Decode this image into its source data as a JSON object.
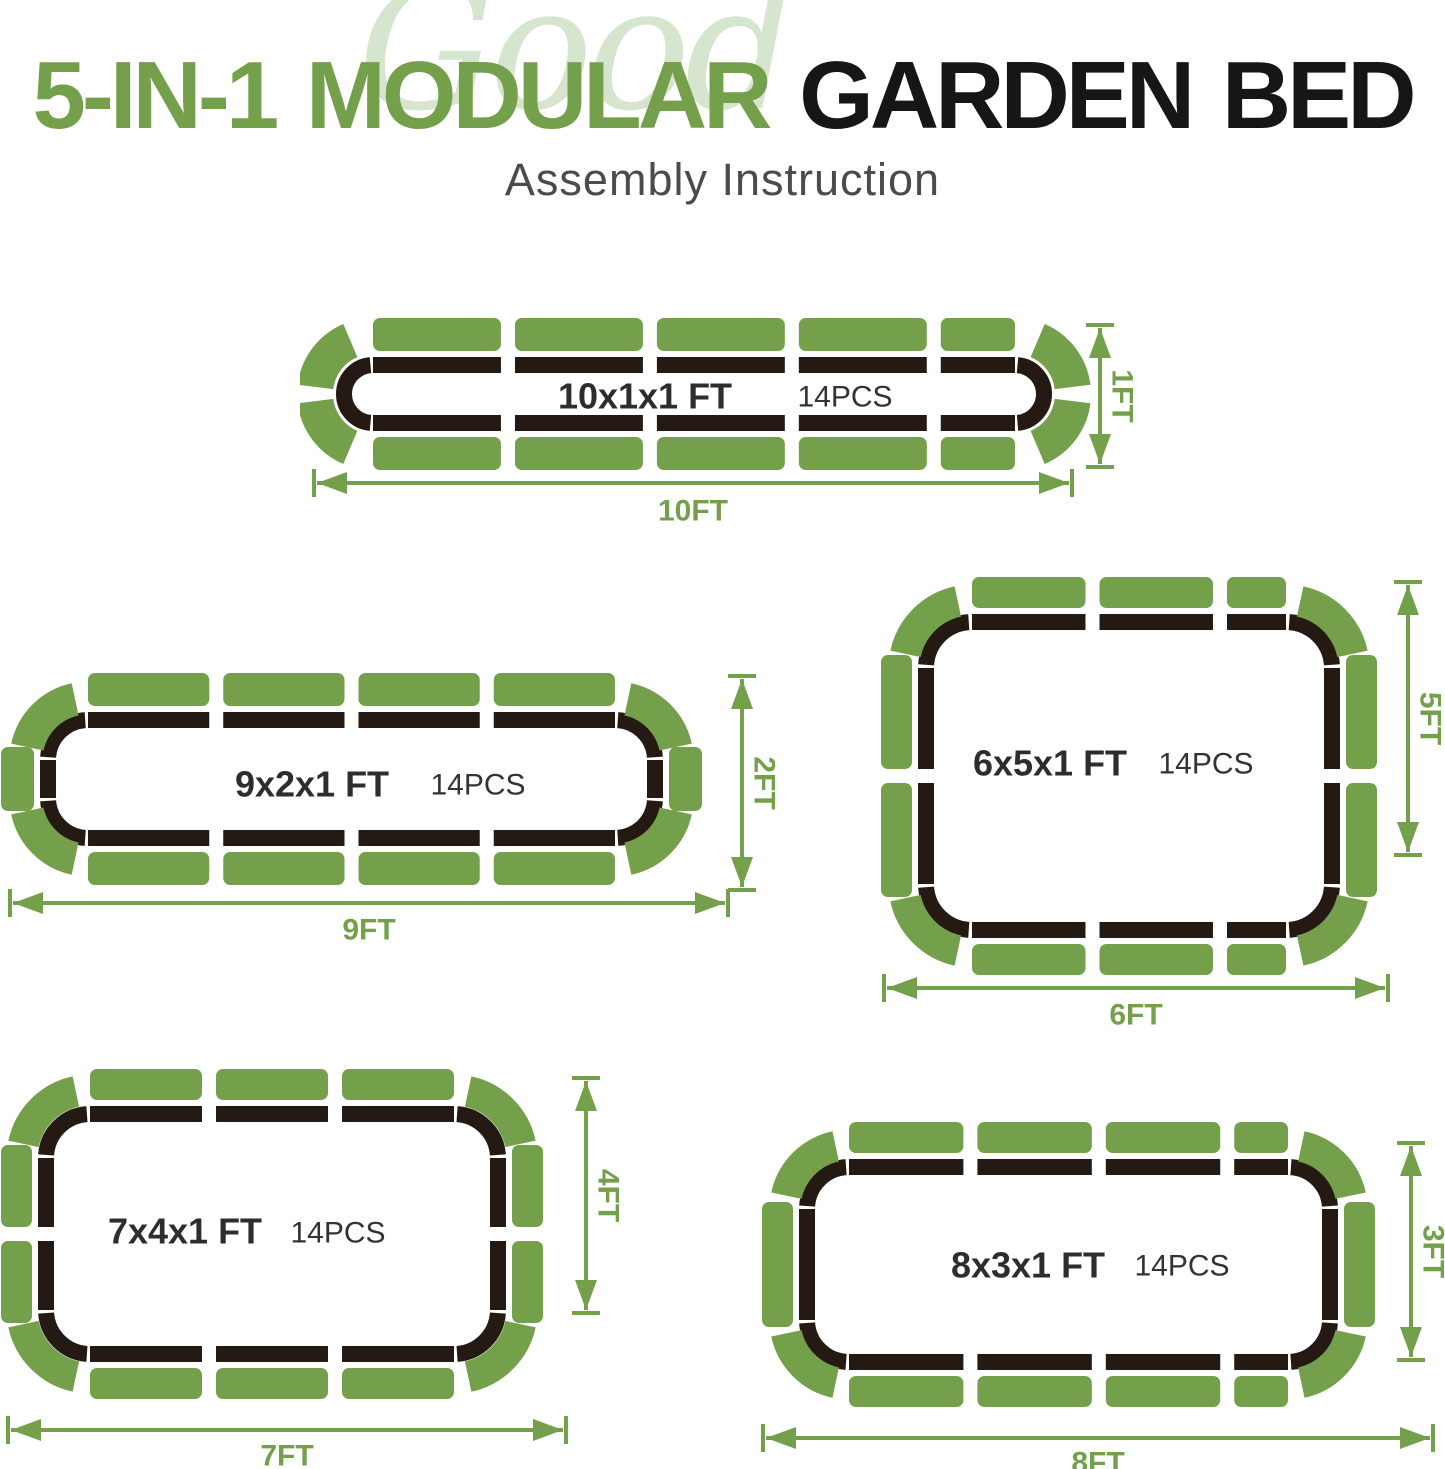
{
  "header": {
    "watermark": "Good",
    "title_green": "5-IN-1 MODULAR",
    "title_dark": "GARDEN BED",
    "subtitle": "Assembly Instruction"
  },
  "colors": {
    "green": "#74A04B",
    "black": "#241A13",
    "watermark_green": "#CCDFC2",
    "title_dark": "#161616",
    "subtitle_gray": "#4B4B4B",
    "label_dark": "#2D2D2D",
    "pcs_dark": "#333333"
  },
  "beds": [
    {
      "name": "10x1x1-ft",
      "size_label": "10x1x1 FT",
      "pcs_label": "14PCS",
      "width_label": "10FT",
      "height_label": "1FT",
      "pieces": {
        "top": 5,
        "bottom": 5,
        "left": 0,
        "right": 0,
        "corners": 4,
        "total": 14
      }
    },
    {
      "name": "9x2x1-ft",
      "size_label": "9x2x1 FT",
      "pcs_label": "14PCS",
      "width_label": "9FT",
      "height_label": "2FT",
      "pieces": {
        "top": 4,
        "bottom": 4,
        "left": 1,
        "right": 1,
        "corners": 4,
        "total": 14
      }
    },
    {
      "name": "6x5x1-ft",
      "size_label": "6x5x1 FT",
      "pcs_label": "14PCS",
      "width_label": "6FT",
      "height_label": "5FT",
      "pieces": {
        "top": 3,
        "bottom": 3,
        "left": 2,
        "right": 2,
        "corners": 4,
        "total": 14
      }
    },
    {
      "name": "7x4x1-ft",
      "size_label": "7x4x1 FT",
      "pcs_label": "14PCS",
      "width_label": "7FT",
      "height_label": "4FT",
      "pieces": {
        "top": 3,
        "bottom": 3,
        "left": 2,
        "right": 2,
        "corners": 4,
        "total": 14
      }
    },
    {
      "name": "8x3x1-ft",
      "size_label": "8x3x1 FT",
      "pcs_label": "14PCS",
      "width_label": "8FT",
      "height_label": "3FT",
      "pieces": {
        "top": 4,
        "bottom": 4,
        "left": 1,
        "right": 1,
        "corners": 4,
        "total": 14
      }
    }
  ]
}
